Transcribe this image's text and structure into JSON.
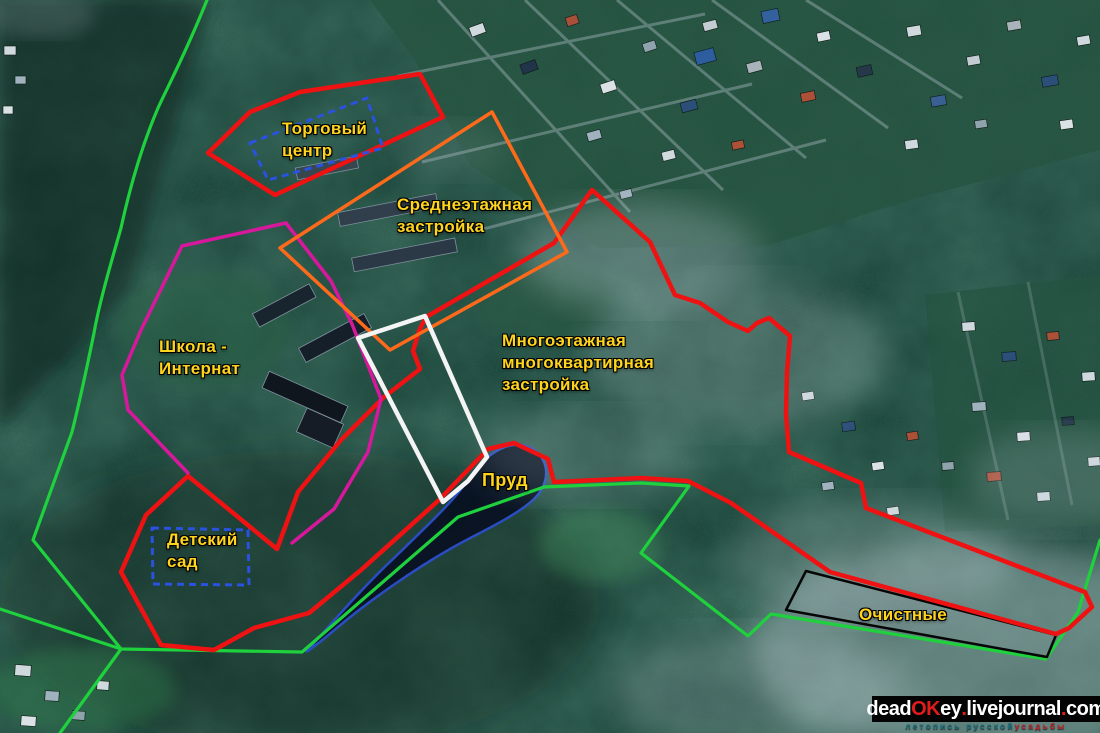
{
  "map": {
    "description": "Annotated satellite plan of Stulov estate surroundings",
    "labels": {
      "shopping_center": "Торговый\nцентр",
      "mid_rise": "Среднеэтажная\nзастройка",
      "boarding_school": "Школа -\nИнтернат",
      "multi_storey": "Многоэтажная\nмногоквартирная\nзастройка",
      "estate": "Территория\nусадьбы\nСтуловых",
      "pond": "Пруд",
      "kindergarten": "Детский\nсад",
      "treatment_plant": "Очистные"
    },
    "colors": {
      "label_yellow": "#ffd41e",
      "estate_label_text": "#0d0d0d",
      "boundary_red": "#ef1212",
      "boundary_green": "#1ed13d",
      "school_outline_magenta": "#d8189c",
      "midrise_outline_orange": "#ff6a1a",
      "dashed_outline_blue": "#2a52e0",
      "estate_outline_white": "#f4f4f4",
      "treatment_outline_black": "#060606",
      "pond_outline_blue": "#2b4fd0"
    }
  },
  "watermark": {
    "parts": [
      {
        "text": "dead",
        "color": "#ffffff"
      },
      {
        "text": "OK",
        "color": "#e01b1b"
      },
      {
        "text": "ey",
        "color": "#ffffff"
      },
      {
        "text": ".",
        "color": "#e01b1b"
      },
      {
        "text": "livejournal",
        "color": "#ffffff"
      },
      {
        "text": ".",
        "color": "#e01b1b"
      },
      {
        "text": "com",
        "color": "#ffffff"
      }
    ],
    "tagline": [
      {
        "text": "летопись русской ",
        "color": "#15707f"
      },
      {
        "text": "усадьбы",
        "color": "#c3232a"
      }
    ]
  }
}
